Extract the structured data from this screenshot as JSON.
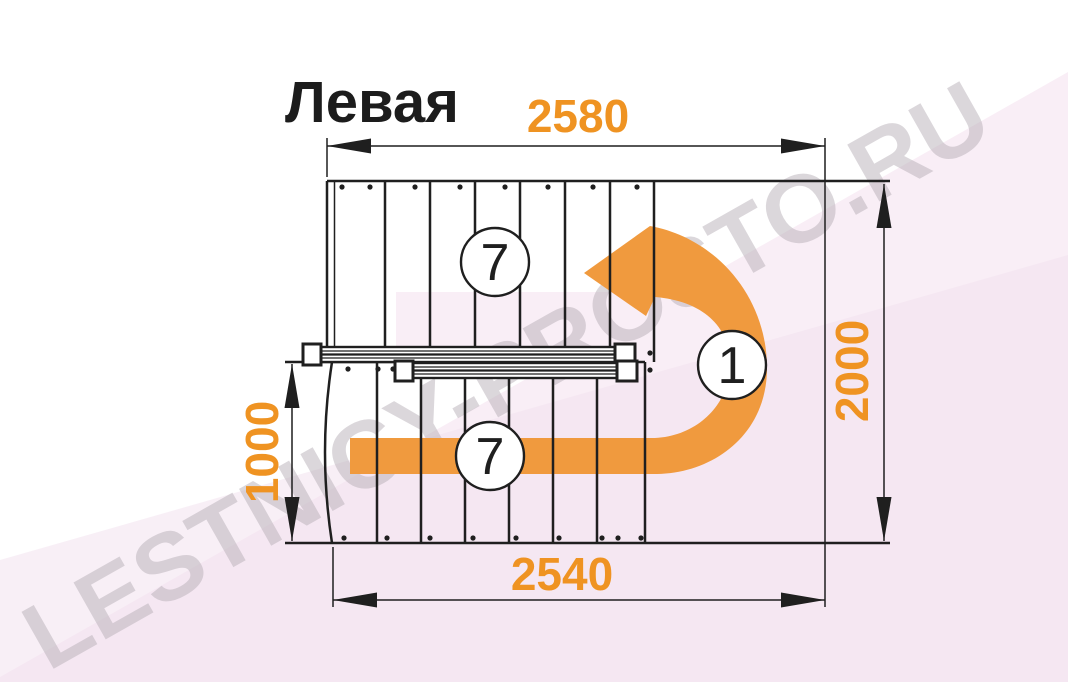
{
  "title": "Левая",
  "watermark": "LESTNICY-PROSTO.RU",
  "dimensions": {
    "top_width_mm": "2580",
    "right_height_mm": "2000",
    "left_height_mm": "1000",
    "bottom_width_mm": "2540"
  },
  "markers": {
    "upper_flight_steps": "7",
    "lower_flight_steps": "7",
    "landing_number": "1"
  },
  "colors": {
    "dim_text_orange": "#ef9322",
    "arrow_orange": "#f09a3e",
    "line_black": "#1f1f1f",
    "title_black": "#1c1c1c",
    "pink_band": "#f9eef6",
    "pink_band_overlay": "#f2e2ee",
    "watermark_gray": "#b8b0b8"
  }
}
